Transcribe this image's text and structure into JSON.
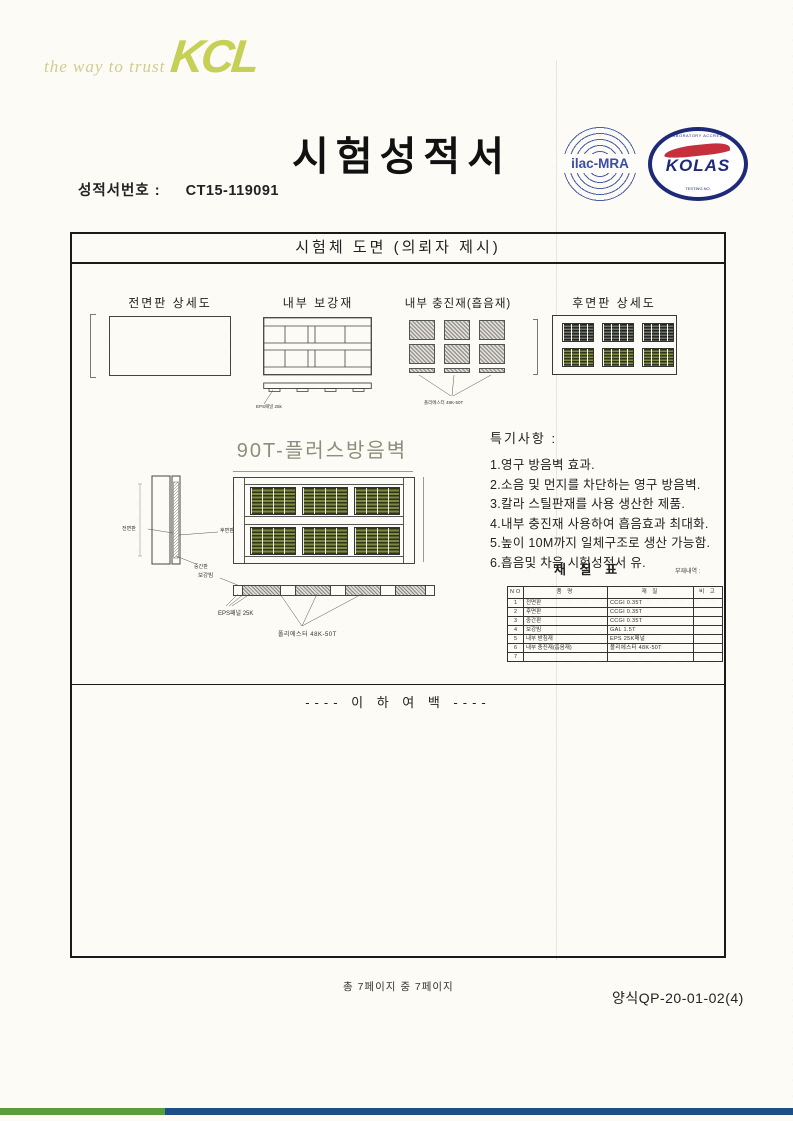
{
  "brand": {
    "tagline": "the way to trust",
    "logo_text": "KCL"
  },
  "header": {
    "title": "시험성적서",
    "report_no_label": "성적서번호 :",
    "report_no": "CT15-119091",
    "ilac_label": "ilac-MRA",
    "kolas_label": "KOLAS",
    "kolas_ring_text": "KOREA LABORATORY ACCREDITATION SCHEME",
    "kolas_sub_text": "TESTING NO."
  },
  "drawing": {
    "header": "시험체 도면 (의뢰자 제시)",
    "top_panels": [
      {
        "label": "전면판 상세도"
      },
      {
        "label": "내부 보강재",
        "note": "EPS패널 25k"
      },
      {
        "label": "내부 충진재(흡음재)",
        "note": "폴리에스터 48K-50T"
      },
      {
        "label": "후면판 상세도"
      }
    ],
    "main_title": "90T-플러스방음벽",
    "side_view_labels": {
      "front": "전면판",
      "rear": "후면판",
      "middle": "중간판"
    },
    "section_labels": {
      "beam": "보강빔",
      "eps": "EPS패널 25K",
      "polyester": "폴리에스터 48K-50T"
    },
    "notes": {
      "title": "특기사항 :",
      "items": [
        "1.영구 방음벽 효과.",
        "2.소음 및 먼지를 차단하는 영구 방음벽.",
        "3.칼라 스틸판재를 사용 생산한 제품.",
        "4.내부 충진재 사용하여 흡음효과 최대화.",
        "5.높이 10M까지 일체구조로 생산 가능함.",
        "6.흡음및 차음 시험성적서 유."
      ]
    },
    "material_table": {
      "title": "재 질 표",
      "side_note": "부재내역 :",
      "headers": [
        "NO",
        "품 명",
        "재 질",
        "비 고"
      ],
      "rows": [
        {
          "no": "1",
          "name": "전면판",
          "spec": "CCGI 0.35T",
          "remark": ""
        },
        {
          "no": "2",
          "name": "후면판",
          "spec": "CCGI 0.35T",
          "remark": ""
        },
        {
          "no": "3",
          "name": "중간판",
          "spec": "CCGI 0.35T",
          "remark": ""
        },
        {
          "no": "4",
          "name": "보강빔",
          "spec": "GAL 1.5T",
          "remark": ""
        },
        {
          "no": "5",
          "name": "내부 받침재",
          "spec": "EPS 25K패널",
          "remark": ""
        },
        {
          "no": "6",
          "name": "내부 충진재(흡음재)",
          "spec": "폴리에스터 48K-50T",
          "remark": ""
        },
        {
          "no": "7",
          "name": "",
          "spec": "",
          "remark": ""
        }
      ]
    },
    "blank_note": "---- 이 하 여 백 ----"
  },
  "footer": {
    "page_info": "총 7페이지 중 7페이지",
    "form_no": "양식QP-20-01-02(4)"
  },
  "colors": {
    "brand_green": "#c5d054",
    "seal_blue": "#1e2a78",
    "seal_red": "#c5303c",
    "bar_green": "#5a9e3b",
    "bar_blue": "#1d4e85",
    "louvre_olive": "#7f8b3f"
  }
}
